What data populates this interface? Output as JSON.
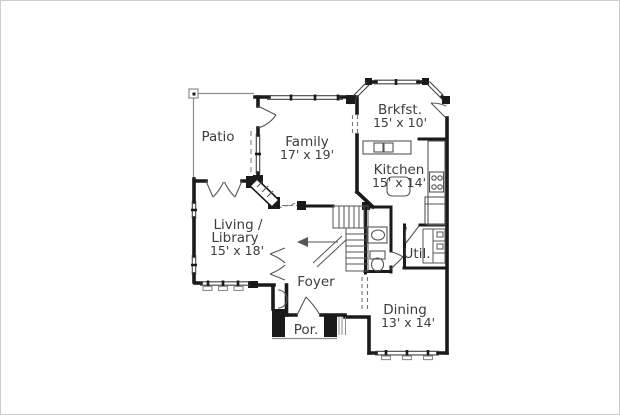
{
  "rooms": {
    "patio": {
      "label": "Patio"
    },
    "family": {
      "label": "Family",
      "dims": "17' x 19'"
    },
    "breakfast": {
      "label": "Brkfst.",
      "dims": "15' x 10'"
    },
    "kitchen": {
      "label": "Kitchen",
      "dims": "15' x 14'"
    },
    "living_library": {
      "label_line1": "Living /",
      "label_line2": "Library",
      "dims": "15' x 18'"
    },
    "foyer": {
      "label": "Foyer"
    },
    "utility": {
      "label": "Util."
    },
    "dining": {
      "label": "Dining",
      "dims": "13' x 14'"
    },
    "porch": {
      "label": "Por."
    }
  },
  "colors": {
    "wall": "#1a1a1a",
    "thin_line": "#8c8c8c",
    "fixture_line": "#555555",
    "text": "#3d3d3d",
    "background": "#ffffff",
    "page_border": "#cccccc"
  }
}
